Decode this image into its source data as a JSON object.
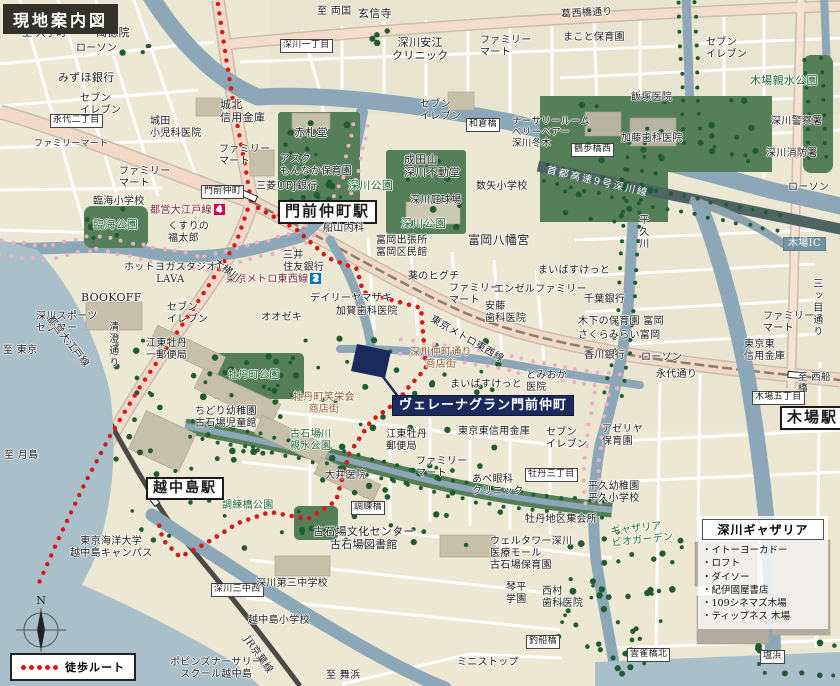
{
  "title_badge": "現地案内図",
  "compass_label": "N",
  "legend": {
    "walk_route_label": "徒歩ルート"
  },
  "gatharia_panel": {
    "title": "深川ギャザリア",
    "items": [
      "・イトーヨーカドー",
      "・ロフト",
      "・ダイソー",
      "・紀伊國屋書店",
      "・109シネマズ木場",
      "・ティップネス 木場"
    ]
  },
  "colors": {
    "route_red": "#d91717",
    "water": "#8ca7b7",
    "water_light": "#a9bfca",
    "park": "#557f58",
    "tree": "#1f5c31",
    "cherry": "#eeb0c3",
    "road_main": "#f2d9c7",
    "highway": "#4e6463",
    "navy": "#1b2a5c"
  },
  "routes": {
    "walk": [
      [
        258,
        208
      ],
      [
        296,
        229
      ],
      [
        328,
        258
      ],
      [
        357,
        269
      ],
      [
        363,
        292
      ],
      [
        421,
        308
      ],
      [
        426,
        368
      ],
      [
        406,
        390
      ],
      [
        398,
        401
      ],
      [
        371,
        421
      ],
      [
        349,
        454
      ],
      [
        336,
        501
      ],
      [
        308,
        519
      ],
      [
        270,
        512
      ],
      [
        238,
        523
      ],
      [
        205,
        544
      ],
      [
        180,
        557
      ],
      [
        163,
        540
      ],
      [
        157,
        517
      ]
    ],
    "oedo_line": [
      [
        218,
        4
      ],
      [
        226,
        58
      ],
      [
        235,
        112
      ],
      [
        244,
        160
      ],
      [
        251,
        200
      ],
      [
        236,
        243
      ],
      [
        207,
        288
      ],
      [
        174,
        337
      ],
      [
        140,
        387
      ],
      [
        110,
        436
      ],
      [
        84,
        485
      ],
      [
        58,
        540
      ],
      [
        38,
        585
      ]
    ]
  },
  "labels": [
    {
      "t": "至 大手町",
      "x": 22,
      "y": 28
    },
    {
      "t": "ローソン",
      "x": 76,
      "y": 43
    },
    {
      "t": "萬徳院",
      "x": 96,
      "y": 27,
      "s": 11
    },
    {
      "t": "みずほ銀行",
      "x": 58,
      "y": 72,
      "s": 11
    },
    {
      "t": "セブン\nイレブン",
      "x": 80,
      "y": 93
    },
    {
      "t": "ファミリーマート",
      "x": 34,
      "y": 139,
      "s": 9
    },
    {
      "t": "永代二丁目",
      "x": 50,
      "y": 114,
      "c": "wb",
      "s": 9
    },
    {
      "t": "城田\n小児科医院",
      "x": 150,
      "y": 116
    },
    {
      "t": "城北\n信用金庫",
      "x": 220,
      "y": 99,
      "s": 11
    },
    {
      "t": "ファミリー\nマート",
      "x": 219,
      "y": 144
    },
    {
      "t": "ファミリー\nマート",
      "x": 119,
      "y": 166
    },
    {
      "t": "臨海小学校",
      "x": 93,
      "y": 196
    },
    {
      "t": "臨海公園",
      "x": 93,
      "y": 219,
      "c": "g",
      "s": 11
    },
    {
      "t": "くすりの\n福太郎",
      "x": 168,
      "y": 221
    },
    {
      "t": "都営大江戸線",
      "x": 150,
      "y": 204,
      "c": "oedo",
      "badge": "4",
      "badge_color": "#ce0058"
    },
    {
      "t": "門前仲町",
      "x": 201,
      "y": 185,
      "c": "wb",
      "s": 9
    },
    {
      "t": "三菱UFJ銀行",
      "x": 256,
      "y": 181
    },
    {
      "t": "門前仲町駅",
      "x": 278,
      "y": 200,
      "c": "st",
      "s": 15,
      "n": "monzen-nakacho-station-label"
    },
    {
      "t": "至 両国",
      "x": 317,
      "y": 6
    },
    {
      "t": "玄信寺",
      "x": 358,
      "y": 8,
      "s": 11
    },
    {
      "t": "深川一丁目",
      "x": 280,
      "y": 39,
      "c": "wb",
      "s": 9
    },
    {
      "t": "深川安江\nクリニック",
      "x": 392,
      "y": 37,
      "c": "ctr",
      "s": 11
    },
    {
      "t": "ファミリー\nマート",
      "x": 480,
      "y": 35
    },
    {
      "t": "まこと保育園",
      "x": 563,
      "y": 32
    },
    {
      "t": "葛西橋通り",
      "x": 561,
      "y": 9,
      "r": -3
    },
    {
      "t": "セブン\nイレブン",
      "x": 706,
      "y": 37
    },
    {
      "t": "木場親水公園",
      "x": 750,
      "y": 75,
      "c": "g",
      "s": 11
    },
    {
      "t": "飯塚医院",
      "x": 631,
      "y": 92
    },
    {
      "t": "加藤歯科医院",
      "x": 621,
      "y": 133
    },
    {
      "t": "深川警察署",
      "x": 771,
      "y": 116
    },
    {
      "t": "深川消防署",
      "x": 766,
      "y": 148
    },
    {
      "t": "ローソン",
      "x": 788,
      "y": 182
    },
    {
      "t": "鶴歩橋西",
      "x": 571,
      "y": 143,
      "c": "wb",
      "s": 9
    },
    {
      "t": "首都高速9号深川線",
      "x": 548,
      "y": 165,
      "c": "hw",
      "r": 13
    },
    {
      "t": "木場IC",
      "x": 783,
      "y": 237,
      "c": "bl",
      "n": "kiba-ic-label"
    },
    {
      "t": "三ッ目通り",
      "x": 810,
      "y": 278,
      "c": "vt"
    },
    {
      "t": "平久川",
      "x": 636,
      "y": 214,
      "c": "vt"
    },
    {
      "t": "赤札堂",
      "x": 294,
      "y": 127,
      "s": 11
    },
    {
      "t": "アスク\nもんなか保育園",
      "x": 280,
      "y": 154
    },
    {
      "t": "セブン\nイレブン",
      "x": 420,
      "y": 99
    },
    {
      "t": "和倉橋",
      "x": 466,
      "y": 118,
      "c": "wb",
      "s": 9
    },
    {
      "t": "ナーサリールーム\nベリーベアー\n深川冬木",
      "x": 512,
      "y": 116,
      "s": 9.5
    },
    {
      "t": "成田山\n深川不動堂",
      "x": 404,
      "y": 154,
      "s": 11
    },
    {
      "t": "深川公園",
      "x": 348,
      "y": 180,
      "c": "g",
      "s": 11
    },
    {
      "t": "数矢小学校",
      "x": 476,
      "y": 181
    },
    {
      "t": "深川庭球場",
      "x": 410,
      "y": 195
    },
    {
      "t": "深川公園",
      "x": 401,
      "y": 218,
      "c": "g",
      "s": 11
    },
    {
      "t": "富岡八幡宮",
      "x": 468,
      "y": 233,
      "s": 12
    },
    {
      "t": "船山内科",
      "x": 323,
      "y": 223
    },
    {
      "t": "富岡出張所\n富岡区民館",
      "x": 376,
      "y": 235
    },
    {
      "t": "三井\n住友銀行",
      "x": 283,
      "y": 250
    },
    {
      "t": "東京メトロ東西線",
      "x": 226,
      "y": 273,
      "c": "metro",
      "badge": "2",
      "badge_color": "#0079c2"
    },
    {
      "t": "薬のヒグチ",
      "x": 408,
      "y": 271
    },
    {
      "t": "ファミリー\nマート",
      "x": 449,
      "y": 283
    },
    {
      "t": "エンゼルファミリー",
      "x": 494,
      "y": 284
    },
    {
      "t": "安藤\n歯科医院",
      "x": 485,
      "y": 301
    },
    {
      "t": "デイリーヤマザキ",
      "x": 310,
      "y": 293
    },
    {
      "t": "加賀歯科医院",
      "x": 336,
      "y": 306
    },
    {
      "t": "オオゼキ",
      "x": 261,
      "y": 312
    },
    {
      "t": "東京メトロ東西線",
      "x": 434,
      "y": 314,
      "r": 30
    },
    {
      "t": "まいばすけっと",
      "x": 538,
      "y": 265
    },
    {
      "t": "千葉銀行",
      "x": 584,
      "y": 294
    },
    {
      "t": "木下の保育園 富岡",
      "x": 578,
      "y": 316
    },
    {
      "t": "さくらみらい富岡",
      "x": 578,
      "y": 330
    },
    {
      "t": "香川銀行",
      "x": 584,
      "y": 350
    },
    {
      "t": "ローソン",
      "x": 641,
      "y": 352
    },
    {
      "t": "ファミリー\nマート",
      "x": 763,
      "y": 311
    },
    {
      "t": "東京東\n信用金庫",
      "x": 744,
      "y": 339
    },
    {
      "t": "永代通り",
      "x": 656,
      "y": 369
    },
    {
      "t": "至 西船橋",
      "x": 798,
      "y": 372,
      "s": 9.5
    },
    {
      "t": "木場五丁目",
      "x": 752,
      "y": 391,
      "c": "wb",
      "s": 9
    },
    {
      "t": "木場駅",
      "x": 780,
      "y": 406,
      "c": "st",
      "s": 15,
      "n": "kiba-station-label"
    },
    {
      "t": "ホットヨガスタジオ\nLAVA",
      "x": 124,
      "y": 262,
      "c": "ctr"
    },
    {
      "t": "大横川",
      "x": 218,
      "y": 257,
      "r": 38
    },
    {
      "t": "BOOKOFF",
      "x": 81,
      "y": 292,
      "s": 11
    },
    {
      "t": "深川スポーツ\nセンター",
      "x": 36,
      "y": 311
    },
    {
      "t": "至 東京",
      "x": 3,
      "y": 345
    },
    {
      "t": "都営大江戸線",
      "x": 53,
      "y": 314,
      "r": 52
    },
    {
      "t": "清澄通り",
      "x": 106,
      "y": 321,
      "c": "vt"
    },
    {
      "t": "セブン\nイレブン",
      "x": 167,
      "y": 302
    },
    {
      "t": "江東牡丹\n一郵便局",
      "x": 146,
      "y": 338
    },
    {
      "t": "牡丹町公園",
      "x": 228,
      "y": 370,
      "c": "g"
    },
    {
      "t": "牡丹町笑栄会\n商店街",
      "x": 293,
      "y": 392,
      "c": "br ctr"
    },
    {
      "t": "深川仲町通り\n商店街",
      "x": 410,
      "y": 347,
      "c": "br ctr"
    },
    {
      "t": "まいばすけっと",
      "x": 450,
      "y": 379
    },
    {
      "t": "とみおか\n医院",
      "x": 526,
      "y": 370
    },
    {
      "t": "ヴェレーナグラン門前仲町",
      "x": 392,
      "y": 395,
      "c": "nv",
      "s": 13,
      "n": "property-name-label"
    },
    {
      "t": "古石場川\n親水公園",
      "x": 290,
      "y": 429,
      "c": "g"
    },
    {
      "t": "江東牡丹\n郵便局",
      "x": 386,
      "y": 429
    },
    {
      "t": "ファミリー\nマート",
      "x": 416,
      "y": 456
    },
    {
      "t": "あべ眼科\nクリニック",
      "x": 472,
      "y": 474
    },
    {
      "t": "牡丹三丁目",
      "x": 525,
      "y": 468,
      "c": "wb",
      "s": 9
    },
    {
      "t": "東京東信用金庫",
      "x": 458,
      "y": 426
    },
    {
      "t": "セブン\nイレブン",
      "x": 546,
      "y": 427
    },
    {
      "t": "アゼリヤ\n保育園",
      "x": 602,
      "y": 424
    },
    {
      "t": "平久幼稚園\n平久小学校",
      "x": 588,
      "y": 481
    },
    {
      "t": "牡丹地区集会所",
      "x": 525,
      "y": 514
    },
    {
      "t": "大井医院",
      "x": 325,
      "y": 470
    },
    {
      "t": "調練橋公園",
      "x": 222,
      "y": 500,
      "c": "g"
    },
    {
      "t": "調練橋",
      "x": 351,
      "y": 501,
      "c": "wb",
      "s": 9
    },
    {
      "t": "越中島駅",
      "x": 146,
      "y": 477,
      "c": "st",
      "s": 14,
      "n": "etchujima-station-label"
    },
    {
      "t": "ちどり幼稚園\n古石場児童館",
      "x": 195,
      "y": 406
    },
    {
      "t": "至 月島",
      "x": 4,
      "y": 450
    },
    {
      "t": "東京海洋大学\n越中島キャンパス",
      "x": 70,
      "y": 536,
      "c": "ctr"
    },
    {
      "t": "深川三中西",
      "x": 211,
      "y": 583,
      "c": "wb",
      "s": 9
    },
    {
      "t": "深川第三中学校",
      "x": 256,
      "y": 578
    },
    {
      "t": "越中島小学校",
      "x": 248,
      "y": 615
    },
    {
      "t": "ポピンズナーサリー\nスクール越中島",
      "x": 170,
      "y": 657,
      "c": "ctr"
    },
    {
      "t": "JR京葉線",
      "x": 250,
      "y": 634,
      "r": 55
    },
    {
      "t": "至 舞浜",
      "x": 326,
      "y": 670
    },
    {
      "t": "古石場文化センター\n古石場図書館",
      "x": 313,
      "y": 526,
      "c": "ctr",
      "s": 11
    },
    {
      "t": "ウェルタワー深川\n医療モール\n古石場保育園",
      "x": 490,
      "y": 536
    },
    {
      "t": "琴平\n学園",
      "x": 506,
      "y": 582
    },
    {
      "t": "西村\n歯科医院",
      "x": 542,
      "y": 586
    },
    {
      "t": "ミニストップ",
      "x": 457,
      "y": 657
    },
    {
      "t": "釣船橋",
      "x": 526,
      "y": 635,
      "c": "wb",
      "s": 9
    },
    {
      "t": "雲雀橋北",
      "x": 627,
      "y": 648,
      "c": "wb",
      "s": 9
    },
    {
      "t": "塩浜",
      "x": 760,
      "y": 650,
      "c": "wb",
      "s": 9
    },
    {
      "t": "ギャザリア\nビオガーデン",
      "x": 610,
      "y": 526,
      "c": "g",
      "r": -6
    }
  ]
}
